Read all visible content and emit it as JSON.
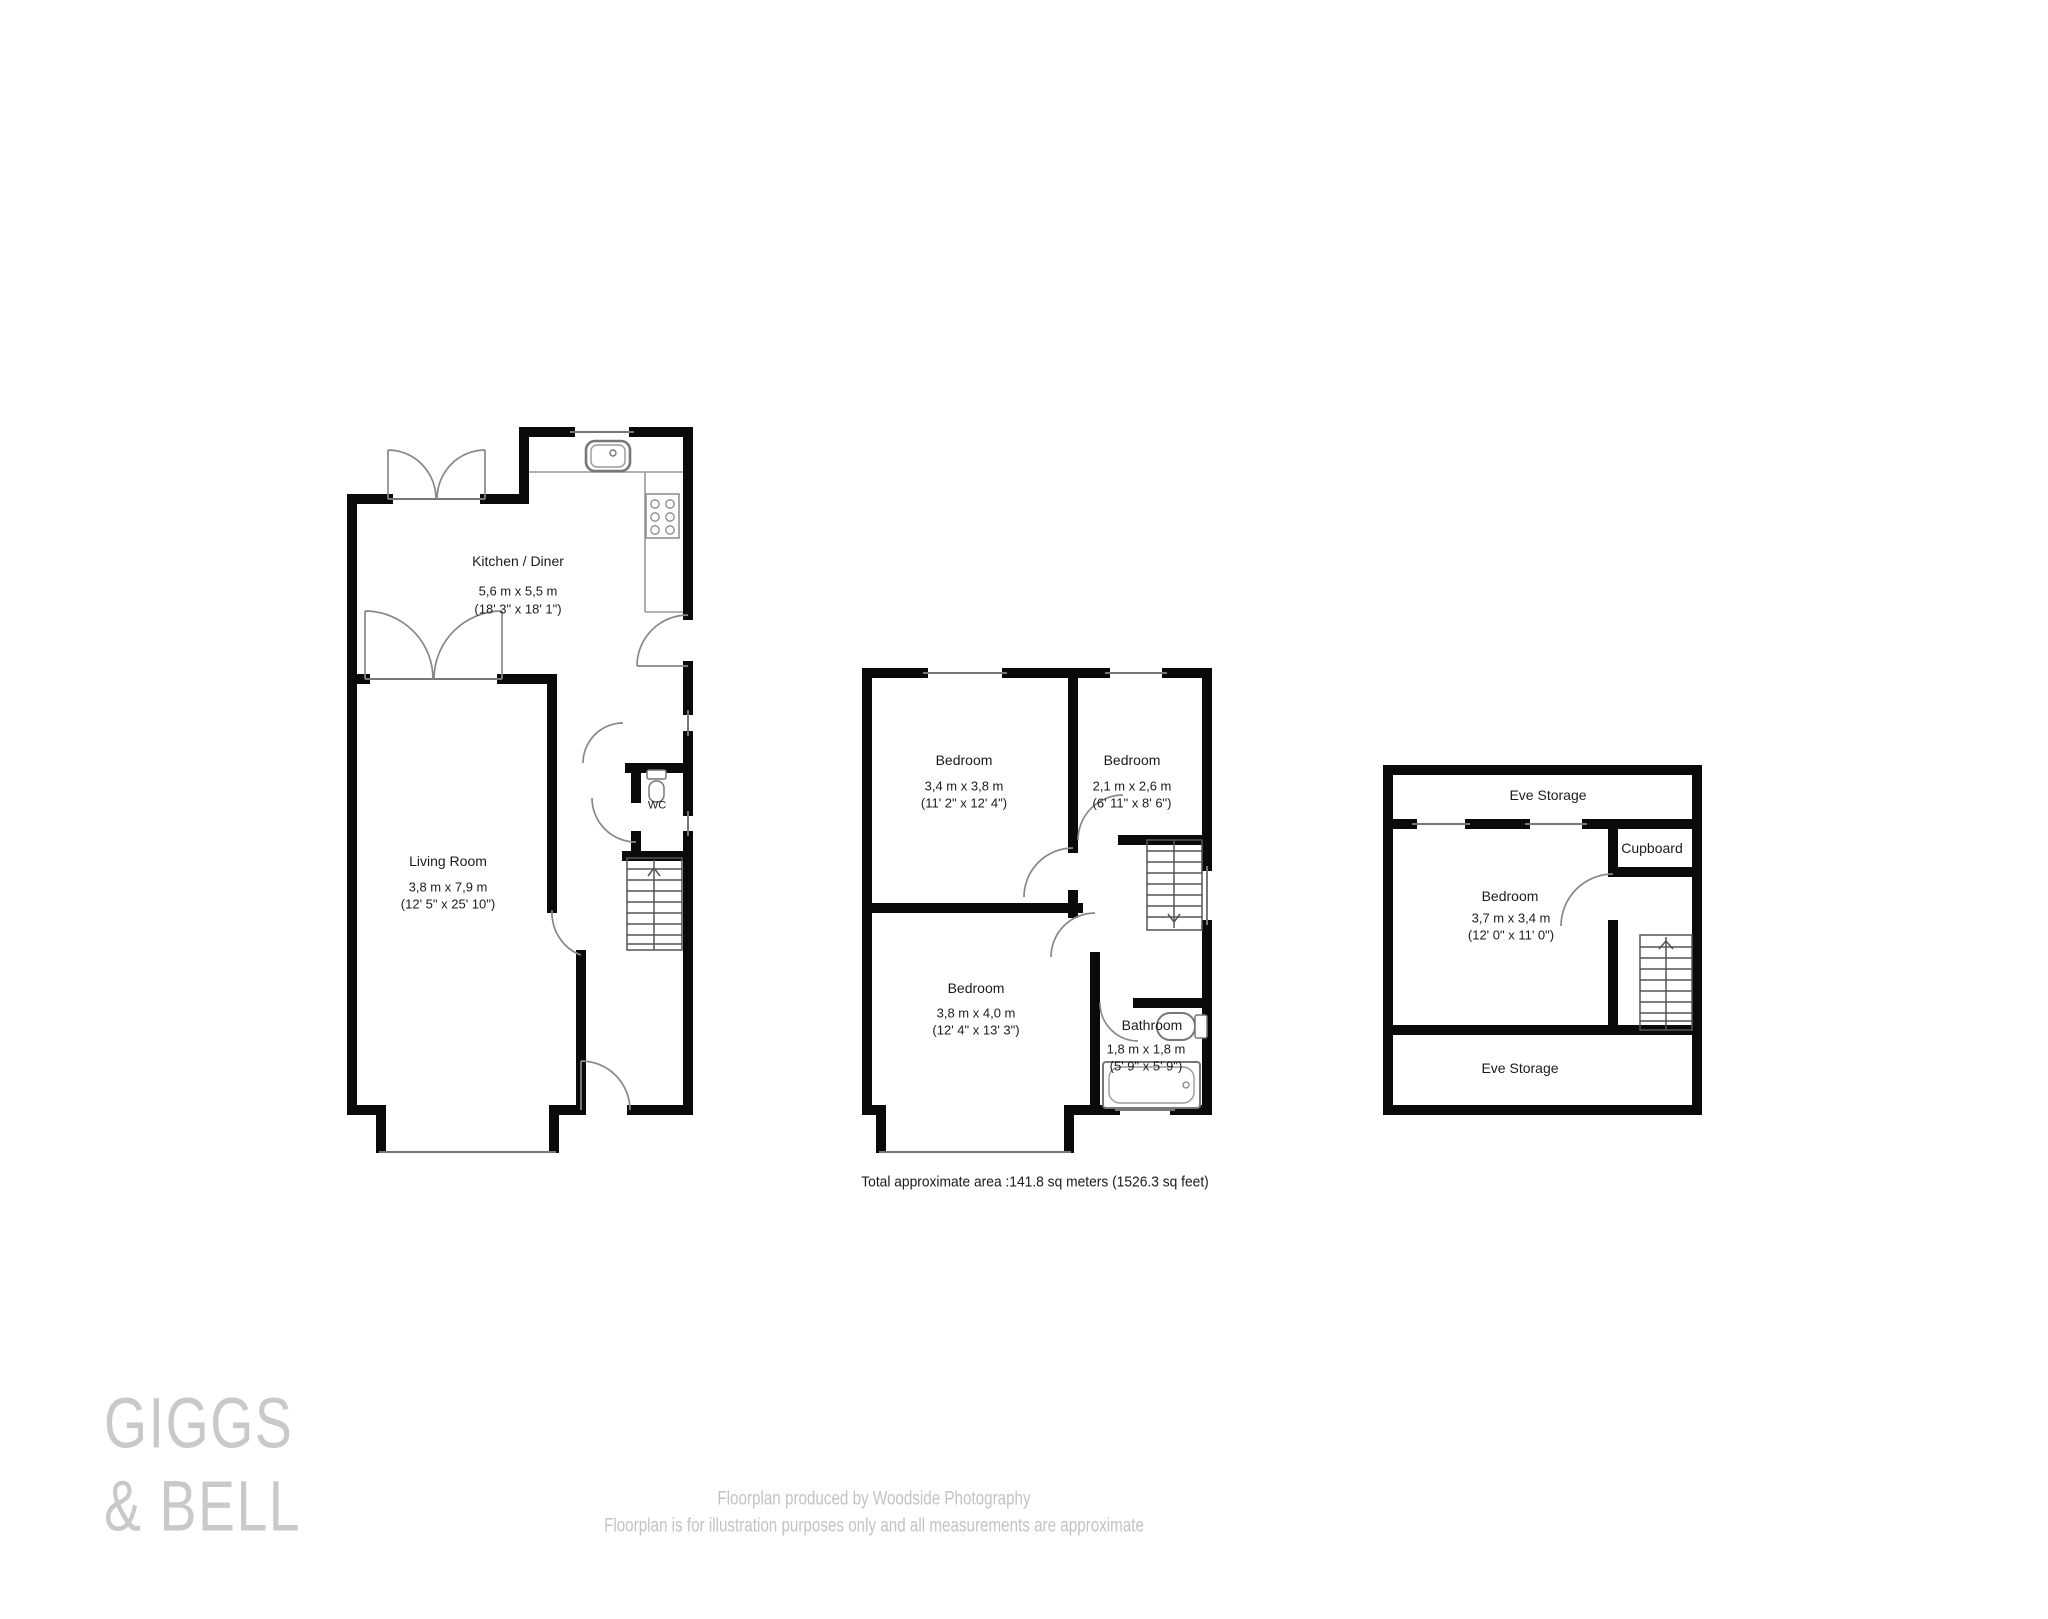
{
  "plans": {
    "ground": {
      "kitchen": {
        "name": "Kitchen / Diner",
        "metric": "5,6 m x 5,5 m",
        "imperial": "(18' 3\" x 18' 1\")"
      },
      "living": {
        "name": "Living Room",
        "metric": "3,8 m x 7,9 m",
        "imperial": "(12' 5\" x 25' 10\")"
      },
      "wc": {
        "name": "WC"
      }
    },
    "first": {
      "bedroom1": {
        "name": "Bedroom",
        "metric": "3,4 m x 3,8 m",
        "imperial": "(11' 2\" x 12' 4\")"
      },
      "bedroom2": {
        "name": "Bedroom",
        "metric": "2,1 m x 2,6 m",
        "imperial": "(6' 11\" x 8' 6\")"
      },
      "bedroom3": {
        "name": "Bedroom",
        "metric": "3,8 m x 4,0 m",
        "imperial": "(12' 4\" x 13' 3\")"
      },
      "bathroom": {
        "name": "Bathroom",
        "metric": "1,8 m x 1,8 m",
        "imperial": "(5' 9\" x 5' 9\")"
      }
    },
    "second": {
      "eve_top": {
        "name": "Eve Storage"
      },
      "cupboard": {
        "name": "Cupboard"
      },
      "bedroom": {
        "name": "Bedroom",
        "metric": "3,7 m x 3,4 m",
        "imperial": "(12' 0\" x 11' 0\")"
      },
      "eve_bottom": {
        "name": "Eve Storage"
      }
    }
  },
  "summary": {
    "total_area": "Total approximate area :141.8 sq meters (1526.3 sq feet)"
  },
  "branding": {
    "logo_line1": "GIGGS",
    "logo_line2": "& BELL"
  },
  "footer": {
    "line1": "Floorplan produced by Woodside Photography",
    "line2": "Floorplan is for illustration purposes only and all measurements are approximate"
  },
  "colors": {
    "wall": "#0a0a0a",
    "thin_line": "#777777",
    "stairs_line": "#555555",
    "label_text": "#1c1c1c",
    "logo_text": "#c9c9c9",
    "footer_text": "#c3c3c3"
  }
}
